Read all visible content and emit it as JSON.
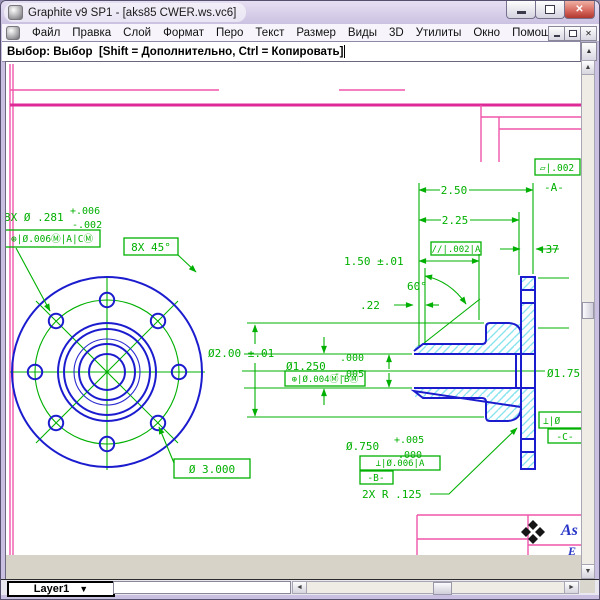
{
  "window": {
    "title": "Graphite v9 SP1 - [aks85 CWER.ws.vc6]"
  },
  "menu": {
    "items": [
      "Файл",
      "Правка",
      "Слой",
      "Формат",
      "Перо",
      "Текст",
      "Размер",
      "Виды",
      "3D",
      "Утилиты",
      "Окно",
      "Помощь"
    ]
  },
  "prompt": {
    "text": "Выбор: Выбор  [Shift = Дополнительно, Ctrl = Копировать]"
  },
  "statusbar": {
    "layer": "Layer1"
  },
  "icons": {
    "up": "▲",
    "down": "▼",
    "left": "◄",
    "right": "►",
    "dropdown": "▼",
    "close": "✕"
  },
  "drawing": {
    "front": {
      "hole_note": "8X Ø .281",
      "hole_tol_plus": "+.006",
      "hole_tol_minus": "-.002",
      "hole_fcf": "⊕|Ø.006Ⓜ|A|CⓂ",
      "chamfer_note": "8X 45°",
      "bolt_circle": "Ø 3.000"
    },
    "side": {
      "d250": "2.50",
      "d225": "2.25",
      "d37": ".37",
      "d150": "1.50 ±.01",
      "a60": "60°",
      "d22": ".22",
      "flatness": "▱|.002",
      "datum_a": "-A-",
      "parallel": "//|.002|A",
      "d200": "Ø2.00 ±.01",
      "d1250": "Ø1.250",
      "d1250_plus": ".000",
      "d1250_minus": "-.005",
      "d1250_fcf": "⊕|Ø.004Ⓜ|BⓂ",
      "d175": "Ø1.75",
      "d750": "Ø.750",
      "d750_plus": "+.005",
      "d750_minus": ".000",
      "d750_fcf": "⊥|Ø.006|A",
      "datum_b": "-B-",
      "radius_note": "2X R .125",
      "fcf_c": "⊥|Ø",
      "datum_c": "-C-"
    },
    "title_block": {
      "brand": "As",
      "line2": "E"
    }
  }
}
